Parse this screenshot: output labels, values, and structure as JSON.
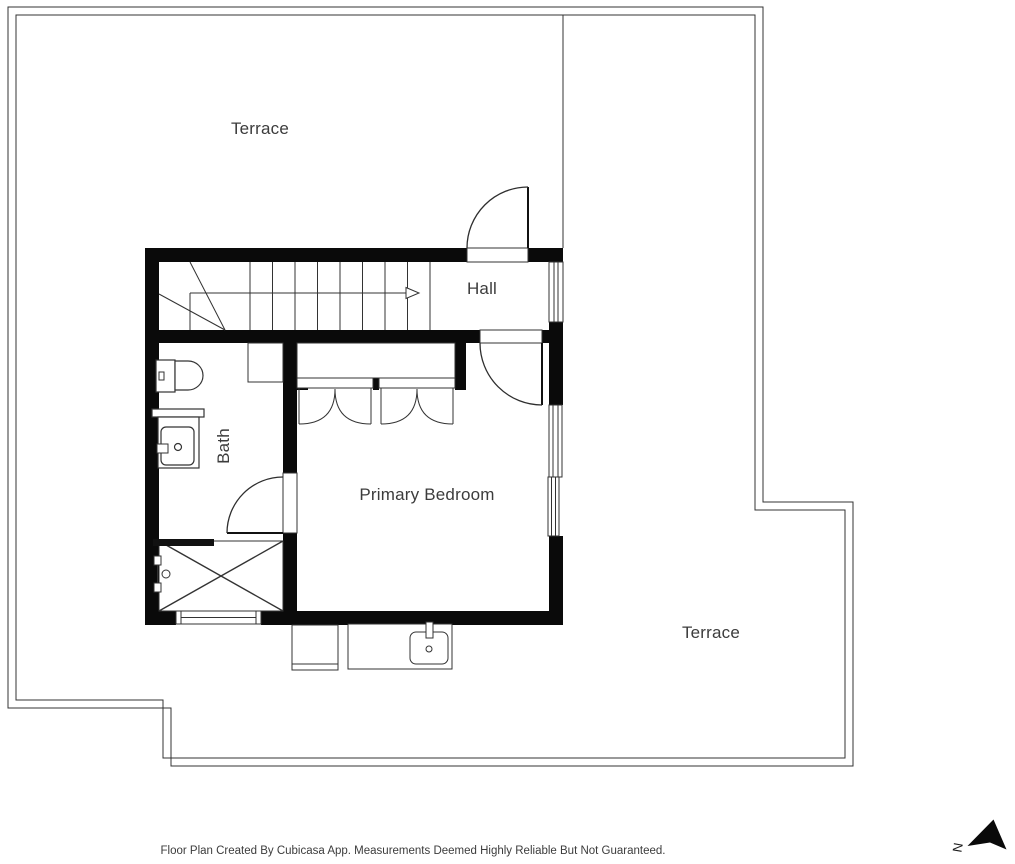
{
  "plan": {
    "rooms": {
      "terrace_upper": "Terrace",
      "hall": "Hall",
      "bath": "Bath",
      "primary_bedroom": "Primary Bedroom",
      "terrace_lower": "Terrace"
    },
    "fixtures": {
      "staircase": "staircase-with-up-arrow",
      "entrance_door": "door-swing",
      "bedroom_door": "door-swing",
      "bath_door": "door-swing",
      "closet_doors": "bifold-closet-doors",
      "toilet": "toilet",
      "vanity": "vanity-sink",
      "shower": "shower-with-cross",
      "bath_cabinet": "cabinet",
      "outdoor_unit": "outdoor-unit",
      "outdoor_sink": "outdoor-sink",
      "windows": "window-symbols"
    },
    "compass": {
      "north_label": "N"
    },
    "footer": {
      "disclaimer": "Floor Plan Created By Cubicasa App. Measurements Deemed Highly Reliable But Not Guaranteed."
    },
    "colors": {
      "walls": "#0a0a0a",
      "thin_lines": "#333333",
      "text": "#3c3c3c",
      "background": "#ffffff"
    }
  }
}
